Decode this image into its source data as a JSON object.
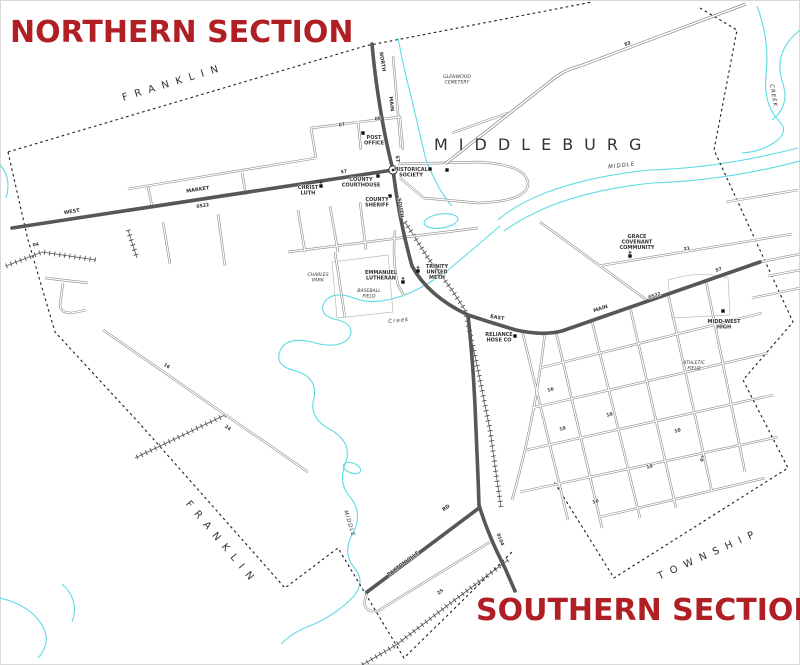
{
  "titles": {
    "northern": "NORTHERN SECTION",
    "southern": "SOUTHERN SECTION"
  },
  "town": {
    "label": "MIDDLEBURG"
  },
  "colors": {
    "section_red": "#b01f23",
    "creek_cyan": "#5fdbe4",
    "main_road_gray": "#575757",
    "boundary_black": "#1c1c1c"
  },
  "labels": [
    {
      "text": "F R A N K L I N",
      "x": 172,
      "y": 86,
      "rot": -17,
      "cls": "twp",
      "name": "township-label-franklin-north"
    },
    {
      "text": "F R A N K L I N",
      "x": 218,
      "y": 543,
      "rot": 50,
      "cls": "twp",
      "name": "township-label-franklin-south"
    },
    {
      "text": "T O W N S H I P",
      "x": 708,
      "y": 558,
      "rot": -24,
      "cls": "twp",
      "name": "township-label-township"
    },
    {
      "text": "WEST",
      "x": 72,
      "y": 213,
      "rot": -9,
      "cls": "st",
      "name": "street-label-west"
    },
    {
      "text": "MARKET",
      "x": 198,
      "y": 191,
      "rot": -9,
      "cls": "st",
      "name": "street-label-market"
    },
    {
      "text": "NORTH",
      "x": 381,
      "y": 62,
      "rot": 81,
      "cls": "st",
      "name": "street-label-north"
    },
    {
      "text": "MAIN",
      "x": 390,
      "y": 104,
      "rot": 83,
      "cls": "st",
      "name": "street-label-main-n"
    },
    {
      "text": "ST",
      "x": 396,
      "y": 159,
      "rot": 84,
      "cls": "st",
      "name": "street-label-st"
    },
    {
      "text": "SOUTH",
      "x": 399,
      "y": 208,
      "rot": 81,
      "cls": "st",
      "name": "street-label-south"
    },
    {
      "text": "EAST",
      "x": 497,
      "y": 319,
      "rot": 10,
      "cls": "st",
      "name": "street-label-east"
    },
    {
      "text": "MAIN",
      "x": 601,
      "y": 310,
      "rot": -19,
      "cls": "st",
      "name": "street-label-main-e"
    },
    {
      "text": "PAXTONVILLE",
      "x": 404,
      "y": 565,
      "rot": -37,
      "cls": "st",
      "name": "street-label-paxtonville"
    },
    {
      "text": "RD",
      "x": 447,
      "y": 509,
      "rot": -37,
      "cls": "st",
      "name": "street-label-rd"
    },
    {
      "text": "0522",
      "x": 203,
      "y": 207,
      "rot": -9,
      "cls": "rt",
      "name": "route-marker-0522-west"
    },
    {
      "text": "0522",
      "x": 655,
      "y": 297,
      "rot": -19,
      "cls": "rt",
      "name": "route-marker-0522-east"
    },
    {
      "text": "0104",
      "x": 499,
      "y": 540,
      "rot": 68,
      "cls": "rt",
      "name": "route-marker-0104"
    },
    {
      "text": "83",
      "x": 628,
      "y": 45,
      "rot": -21,
      "cls": "rt",
      "name": "route-marker-83"
    },
    {
      "text": "57",
      "x": 719,
      "y": 271,
      "rot": -19,
      "cls": "rt",
      "name": "block-marker-57-east"
    },
    {
      "text": "57",
      "x": 344,
      "y": 173,
      "rot": -9,
      "cls": "rt",
      "name": "block-marker-57-market"
    },
    {
      "text": "21",
      "x": 687,
      "y": 250,
      "rot": -10,
      "cls": "rt",
      "name": "block-marker-21"
    },
    {
      "text": "16",
      "x": 166,
      "y": 367,
      "rot": 35,
      "cls": "rt",
      "name": "block-marker-16-sw"
    },
    {
      "text": "24",
      "x": 227,
      "y": 429,
      "rot": 35,
      "cls": "rt",
      "name": "block-marker-24"
    },
    {
      "text": "25",
      "x": 441,
      "y": 593,
      "rot": -37,
      "cls": "rt",
      "name": "block-marker-25"
    },
    {
      "text": "07",
      "x": 342,
      "y": 126,
      "rot": -8,
      "cls": "rt",
      "name": "block-marker-07-n"
    },
    {
      "text": "08",
      "x": 378,
      "y": 120,
      "rot": -8,
      "cls": "rt",
      "name": "block-marker-08"
    },
    {
      "text": "04",
      "x": 36,
      "y": 246,
      "rot": -9,
      "cls": "rt",
      "name": "block-marker-04"
    },
    {
      "text": "10",
      "x": 563,
      "y": 430,
      "rot": -17,
      "cls": "rt",
      "name": "block-marker-10-a"
    },
    {
      "text": "10",
      "x": 610,
      "y": 416,
      "rot": -17,
      "cls": "rt",
      "name": "block-marker-10-b"
    },
    {
      "text": "10",
      "x": 650,
      "y": 468,
      "rot": -17,
      "cls": "rt",
      "name": "block-marker-10-c"
    },
    {
      "text": "10",
      "x": 596,
      "y": 503,
      "rot": -17,
      "cls": "rt",
      "name": "block-marker-10-d"
    },
    {
      "text": "16",
      "x": 551,
      "y": 391,
      "rot": -17,
      "cls": "rt",
      "name": "block-marker-16-grid"
    },
    {
      "text": "10",
      "x": 678,
      "y": 432,
      "rot": -17,
      "cls": "rt",
      "name": "block-marker-10-e"
    },
    {
      "text": "07",
      "x": 704,
      "y": 459,
      "rot": -70,
      "cls": "rt",
      "name": "block-marker-07-s"
    },
    {
      "text": "MIDDLE",
      "x": 622,
      "y": 167,
      "rot": -7,
      "cls": "ck",
      "name": "creek-label-middle-east"
    },
    {
      "text": "CREEK",
      "x": 772,
      "y": 96,
      "rot": 80,
      "cls": "ck",
      "name": "creek-label-creek-ne"
    },
    {
      "text": "Creek",
      "x": 399,
      "y": 322,
      "rot": -6,
      "cls": "ck",
      "name": "creek-label-creek-center"
    },
    {
      "text": "MIDDLE",
      "x": 348,
      "y": 524,
      "rot": 73,
      "cls": "ck",
      "name": "creek-label-middle-sw"
    }
  ],
  "places": [
    {
      "lines": [
        "POST",
        "OFFICE"
      ],
      "x": 374,
      "y": 139,
      "cls": "pl",
      "name": "place-post-office"
    },
    {
      "lines": [
        "HISTORICAL",
        "SOCIETY"
      ],
      "x": 411,
      "y": 171,
      "cls": "pl",
      "name": "place-historical-society"
    },
    {
      "lines": [
        "COUNTY",
        "COURTHOUSE"
      ],
      "x": 361,
      "y": 181,
      "cls": "pl",
      "name": "place-county-courthouse"
    },
    {
      "lines": [
        "COUNTY",
        "SHERIFF"
      ],
      "x": 377,
      "y": 201,
      "cls": "pl",
      "name": "place-county-sheriff"
    },
    {
      "lines": [
        "CHRIST",
        "LUTH"
      ],
      "x": 308,
      "y": 189,
      "cls": "pl",
      "name": "place-christ-luth"
    },
    {
      "lines": [
        "EMMANUEL",
        "LUTHERAN"
      ],
      "x": 381,
      "y": 274,
      "cls": "pl",
      "name": "place-emmanuel-lutheran"
    },
    {
      "lines": [
        "TRINITY",
        "UNITED",
        "METH"
      ],
      "x": 437,
      "y": 268,
      "cls": "pl",
      "name": "place-trinity-united-meth"
    },
    {
      "lines": [
        "GRACE",
        "COVENANT",
        "COMMUNITY"
      ],
      "x": 637,
      "y": 238,
      "cls": "pl",
      "name": "place-grace-covenant-community"
    },
    {
      "lines": [
        "MIDD-WEST",
        "HIGH"
      ],
      "x": 724,
      "y": 323,
      "cls": "pl",
      "name": "place-midd-west-high"
    },
    {
      "lines": [
        "RELIANCE",
        "HOSE CO"
      ],
      "x": 499,
      "y": 336,
      "cls": "pl",
      "name": "place-reliance-hose-co"
    },
    {
      "lines": [
        "GLENWOOD",
        "CEMETERY"
      ],
      "x": 457,
      "y": 78,
      "cls": "ar",
      "name": "area-glenwood-cemetery"
    },
    {
      "lines": [
        "CHARLES",
        "PARK"
      ],
      "x": 318,
      "y": 276,
      "cls": "ar",
      "name": "area-charles-park"
    },
    {
      "lines": [
        "BASEBALL",
        "FIELD"
      ],
      "x": 369,
      "y": 292,
      "cls": "ar",
      "name": "area-baseball-field"
    },
    {
      "lines": [
        "ATHLETIC",
        "FIELD"
      ],
      "x": 694,
      "y": 364,
      "cls": "ar",
      "name": "area-athletic-field"
    }
  ],
  "buildings": [
    {
      "x": 363,
      "y": 133,
      "name": "building-post-office"
    },
    {
      "x": 430,
      "y": 169,
      "name": "building-historical-society"
    },
    {
      "x": 447,
      "y": 170,
      "name": "building-historical-society-2"
    },
    {
      "x": 378,
      "y": 176,
      "name": "building-county-courthouse"
    },
    {
      "x": 390,
      "y": 196,
      "name": "building-county-sheriff"
    },
    {
      "x": 723,
      "y": 311,
      "name": "building-midd-west-high"
    },
    {
      "x": 515,
      "y": 336,
      "name": "building-reliance-hose-co"
    },
    {
      "x": 321,
      "y": 186,
      "church": true,
      "name": "church-christ-luth"
    },
    {
      "x": 403,
      "y": 282,
      "church": true,
      "name": "church-emmanuel-lutheran"
    },
    {
      "x": 418,
      "y": 271,
      "church": true,
      "name": "church-trinity-united-meth"
    },
    {
      "x": 630,
      "y": 256,
      "church": true,
      "name": "church-grace-covenant"
    }
  ]
}
